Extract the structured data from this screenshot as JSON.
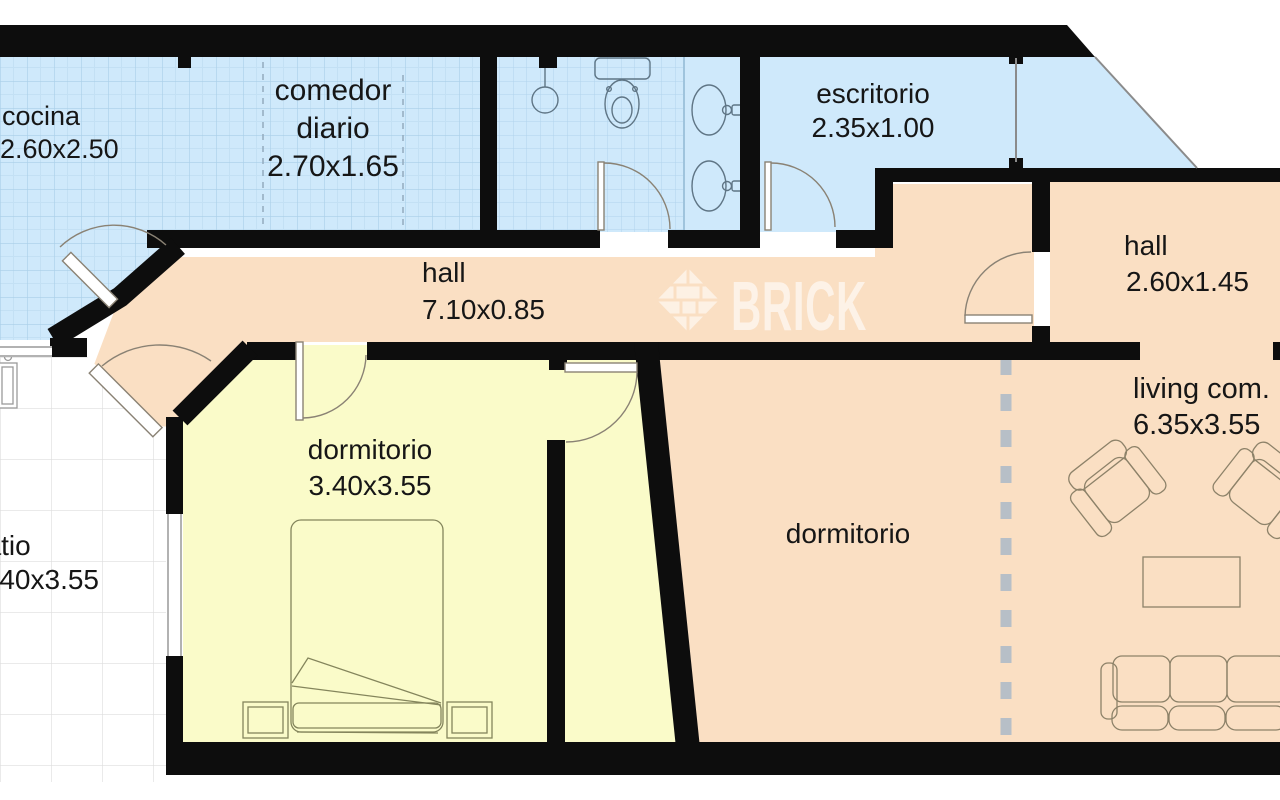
{
  "plan_title": "apartment floor plan",
  "watermark": {
    "text": "BRICK"
  },
  "rooms": {
    "cocina": {
      "label": "cocina",
      "dims": "2.60x2.50"
    },
    "comedor": {
      "label": "comedor",
      "label2": "diario",
      "dims": "2.70x1.65"
    },
    "escritorio": {
      "label": "escritorio",
      "dims": "2.35x1.00"
    },
    "hall_main": {
      "label": "hall",
      "dims": "7.10x0.85"
    },
    "hall_right": {
      "label": "hall",
      "dims": "2.60x1.45"
    },
    "dormitorio1": {
      "label": "dormitorio",
      "dims": "3.40x3.55"
    },
    "dormitorio2": {
      "label": "dormitorio"
    },
    "living": {
      "label": "living com.",
      "dims": "6.35x3.55"
    },
    "patio": {
      "label": "patio",
      "dims": "3.40x3.55"
    }
  },
  "colors": {
    "wall": "#0d0d0d",
    "wet_floor_blue": "#cfe9fb",
    "hall_floor_peach": "#fadfc3",
    "bedroom_floor_yellow": "#fafbc9",
    "patio_floor_white": "#ffffff",
    "tile_line_blue": "#a9cfe8",
    "patio_tile_line": "#dedede",
    "division_dash_gray": "#b7bfc7",
    "fixture_line": "#5f7585",
    "furniture_line": "#8d8269"
  }
}
